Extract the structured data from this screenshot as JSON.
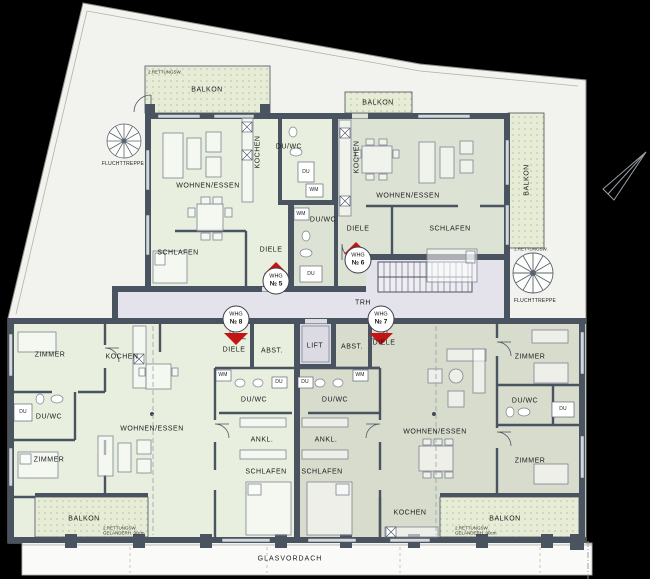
{
  "plan": {
    "common": {
      "trh": "TRH",
      "lift": "LIFT",
      "glasvordach": "GLASVORDACH",
      "fluchttreppe_left": "FLUCHTTREPPE",
      "fluchttreppe_right": "FLUCHTTREPPE",
      "rettungsweg_note": "2.RETTUNGSW.",
      "gelaender_note_line1": "2.RETTUNGSW.",
      "gelaender_note_line2": "GELÄNDERH. 90cm"
    },
    "apartments": {
      "whg5": {
        "badge": {
          "line1": "WHG",
          "line2": "№ 5"
        },
        "rooms": {
          "balkon": "BALKON",
          "kochen": "KOCHEN",
          "duwc": "DU/WC",
          "du": "DU",
          "wm": "WM",
          "wohnen_essen": "WOHNEN/ESSEN",
          "schlafen": "SCHLAFEN",
          "diele": "DIELE"
        }
      },
      "whg6": {
        "badge": {
          "line1": "WHG",
          "line2": "№ 6"
        },
        "rooms": {
          "balkon_top": "BALKON",
          "balkon_right": "BALKON",
          "kochen": "KOCHEN",
          "duwc": "DU/WC",
          "du": "DU",
          "wm": "WM",
          "wohnen_essen": "WOHNEN/ESSEN",
          "schlafen": "SCHLAFEN",
          "diele": "DIELE"
        }
      },
      "whg7": {
        "badge": {
          "line1": "WHG",
          "line2": "№ 7"
        },
        "rooms": {
          "diele": "DIELE",
          "abst": "ABST.",
          "duwc_mitte": "DU/WC",
          "du_mitte": "DU",
          "wm": "WM",
          "ankleide": "ANKL.",
          "schlafen": "SCHLAFEN",
          "wohnen_essen": "WOHNEN/ESSEN",
          "zimmer_oben": "ZIMMER",
          "zimmer_unten": "ZIMMER",
          "duwc_rechts": "DU/WC",
          "du_rechts": "DU",
          "kochen": "KOCHEN",
          "balkon": "BALKON"
        }
      },
      "whg8": {
        "badge": {
          "line1": "WHG",
          "line2": "№ 8"
        },
        "rooms": {
          "diele": "DIELE",
          "abst": "ABST.",
          "zimmer_oben": "ZIMMER",
          "kochen": "KOCHEN",
          "duwc_links": "DU/WC",
          "du_links": "DU",
          "zimmer_unten": "ZIMMER",
          "wohnen_essen": "WOHNEN/ESSEN",
          "duwc_mitte": "DU/WC",
          "du_mitte": "DU",
          "wm": "WM",
          "ankleide": "ANKL.",
          "schlafen": "SCHLAFEN",
          "balkon": "BALKON"
        }
      }
    },
    "colors": {
      "background": "#000000",
      "site": "#f2f2ee",
      "wall": "#4a5360",
      "apartment_light": "#e9efde",
      "apartment_green_gray": "#dde3d4",
      "apartment_gray": "#d7dccd",
      "corridor": "#e4e3ec",
      "balcony": "#e6ecd5",
      "entry_marker_red": "#c41414"
    }
  }
}
